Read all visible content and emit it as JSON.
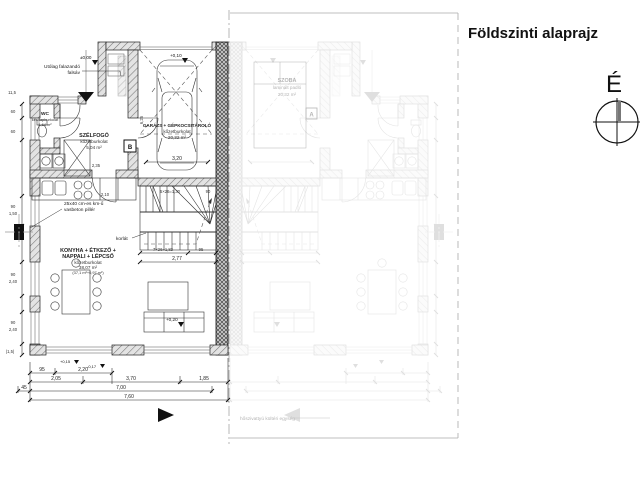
{
  "header": {
    "title": "Földszinti alaprajz"
  },
  "north": {
    "label": "É"
  },
  "rooms": {
    "wc": {
      "name": "WC",
      "finish": "ker. lapburkolat",
      "area": "1,64 m²"
    },
    "szelfogo": {
      "name": "SZÉLFOGÓ",
      "finish": "kőzetburkolat",
      "area": "5,04 m²"
    },
    "garazs": {
      "name": "GARÁZS + GÉPKOCSITÁROLÓ",
      "finish": "kőzetburkolat",
      "area": "20,32 m²"
    },
    "nappali": {
      "name1": "KONYHA + ÉTKEZŐ +",
      "name2": "NAPPALI + LÉPCSŐ",
      "finish": "kőzetburkolat",
      "area": "38,07 m²",
      "detail": "(37,1 m²+0,97 m²)"
    }
  },
  "mirror": {
    "room": {
      "name": "SZOBA",
      "finish": "laminált padló",
      "area": "20,32 m²"
    },
    "section_mark": "A",
    "note": "hőszivattyú kültéri egység"
  },
  "annotations": {
    "wall_note_1": "Utólag falazandó",
    "wall_note_2": "falsáv",
    "pillar_note_1": "25x40 cm-es km-ű",
    "pillar_note_2": "vasbeton pillér",
    "railing": "korlát",
    "section_mark": "B"
  },
  "levels": {
    "entry": "±0,00",
    "garage": "+0,10",
    "living": "+0,20",
    "terrace_a": "+0,15",
    "terrace_b": "-0,17"
  },
  "dims": {
    "b1a": "95",
    "b1b": "2,20",
    "b2a": "2,05",
    "b2b": "3,70",
    "b2c": "1,85",
    "b3a": "45",
    "b3b": "7,00",
    "b4": "7,60",
    "l_top": "11,5",
    "l1": "60",
    "l2": "60",
    "l3": "90",
    "l4": "1,50",
    "l5": "90",
    "l6": "2,40",
    "l7": "90",
    "l8": "2,40",
    "l_bot": "(1,5)",
    "s_top": "5×26=1,30",
    "s_top_w": "90",
    "s_bot": "7×26=1,82",
    "s_bot_w": "95",
    "s_total": "2,77",
    "gar_w": "3,20",
    "gar_d": "6,25",
    "d_szel": "2,35",
    "d_door": "2,10"
  }
}
